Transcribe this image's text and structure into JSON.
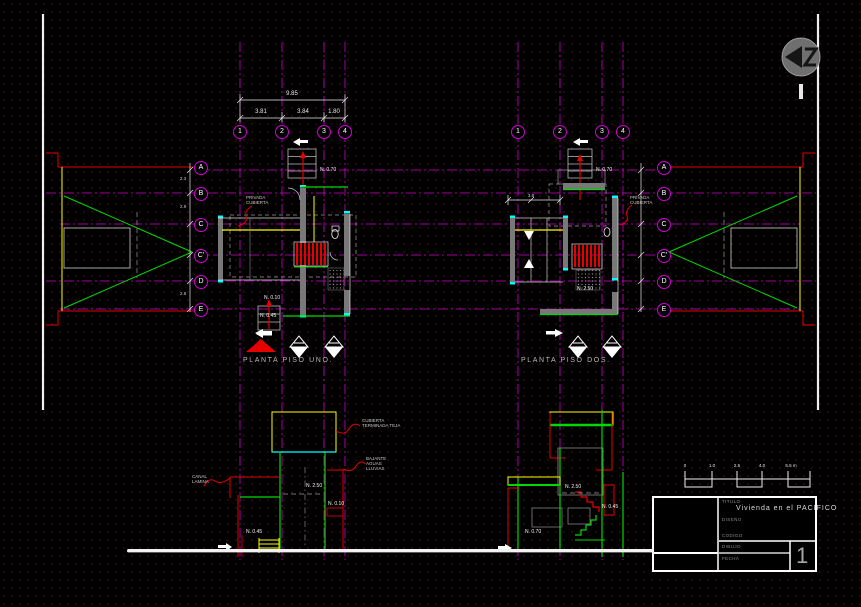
{
  "grid": {
    "cols_left": [
      "1",
      "2",
      "3",
      "4"
    ],
    "cols_right": [
      "1",
      "2",
      "3",
      "4"
    ],
    "rows_left": [
      "A",
      "B",
      "C",
      "C'",
      "D",
      "E"
    ],
    "rows_right": [
      "A",
      "B",
      "C",
      "C'",
      "D",
      "E"
    ]
  },
  "dims": {
    "total": "9.85",
    "seg1": "3.81",
    "seg2": "3.84",
    "seg3": "1.80",
    "side1": "2.3",
    "side2": "2.9",
    "side3": "2.8",
    "right_top": "3.8"
  },
  "plan_left": {
    "title": "PLANTA  PISO  UNO.",
    "entry_level": "N. 0.70",
    "privada": "PRIVADA\nCUBIERTA",
    "level_010": "N. 0.10",
    "level_045": "N. 0.45"
  },
  "plan_right": {
    "title": "PLANTA  PISO  DOS.",
    "entry_level": "N. 0.70",
    "privada": "PRIVADA\nCUBIERTA",
    "level_250": "N. 2.50"
  },
  "section_left": {
    "callout_roof": "CUBIERTA\nTERMINADA TEJA",
    "callout_downspout": "BAJANTE\nAGUAS\nLLUVIAS",
    "callout_gutter": "CANAL\nLAMINA",
    "level_250": "N. 2.50",
    "level_010": "N. 0.10",
    "level_045": "N. 0.45"
  },
  "section_right": {
    "level_250": "N. 2.50",
    "level_045": "N. 0.45",
    "level_070": "N. 0.70"
  },
  "scalebar": {
    "l0": "0",
    "l1": "1.0",
    "l2": "2.5",
    "l3": "4.0",
    "l4": "5.5 m"
  },
  "titleblock": {
    "title_label": "TITULO",
    "title_value": "Vivienda  en  el  PACIFICO",
    "design_label": "DISEÑO",
    "code_label": "CODIGO",
    "drawing_label": "DIBUJO",
    "date_label": "FECHA",
    "sheet_number": "1"
  },
  "colors": {
    "background": "#000000",
    "grid_magenta": "#d400d4",
    "line_red": "#e60000",
    "line_green": "#00d900",
    "line_yellow": "#ffff00",
    "line_cyan": "#00ffff",
    "line_white": "#f2f2f2",
    "wall_gray": "#787878"
  }
}
